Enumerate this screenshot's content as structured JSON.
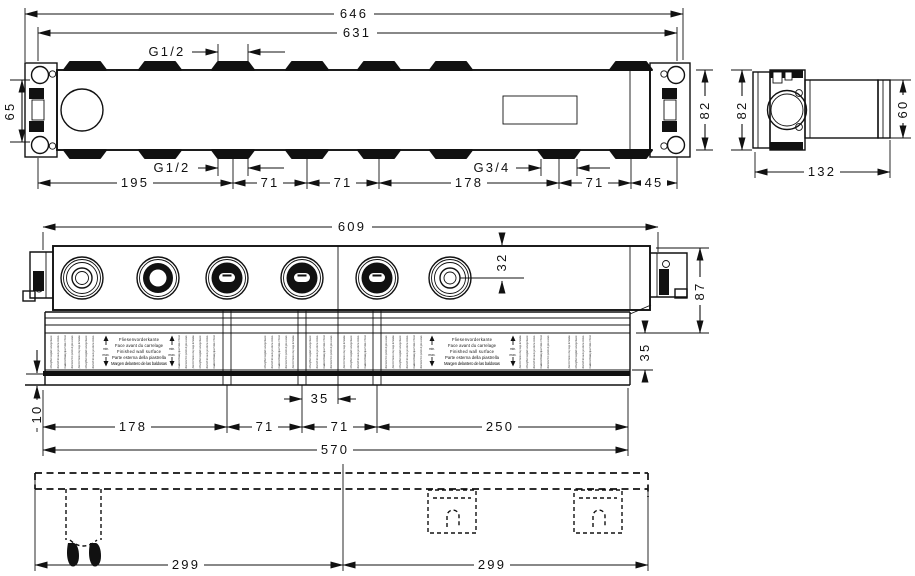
{
  "plan_view": {
    "overall_width": "646",
    "body_width": "631",
    "top_thread": "G1/2",
    "bottom_thread": "G1/2",
    "outlet_thread": "G3/4",
    "bracket_hole_spacing": "65",
    "body_height": "82",
    "spacings": [
      "195",
      "71",
      "71",
      "178",
      "71",
      "45"
    ]
  },
  "side_view": {
    "overall_height": "82",
    "housing_height": "60",
    "depth": "132"
  },
  "front_view": {
    "overall_width": "609",
    "port_axis_offset": "32",
    "overall_height": "87",
    "adjust_range": "35",
    "tile_edge_gap": "10",
    "center_offset": "35",
    "spacings": [
      "178",
      "71",
      "71",
      "250"
    ],
    "mounting_width": "570"
  },
  "footprint_view": {
    "left_half": "299",
    "right_half": "299"
  },
  "label_strip": {
    "languages": [
      "Fliesenvorderkante",
      "Face avant du carrelage",
      "Finished wall surface",
      "Parte esterna della piastrella",
      "Margen delantero de las baldosas"
    ],
    "min_label": "min.",
    "max_label": "max.",
    "warnings": [
      "Achtung! Bei Frostgefahr Leitung entleeren",
      "Attention! En cas de gel vider la conduite",
      "Caution! Drain pipe if risk of frost",
      "Attenzione! Con pericolo di gelo svuotare",
      "¡Atención! Vaciar si hay riesgo de heladas"
    ]
  }
}
